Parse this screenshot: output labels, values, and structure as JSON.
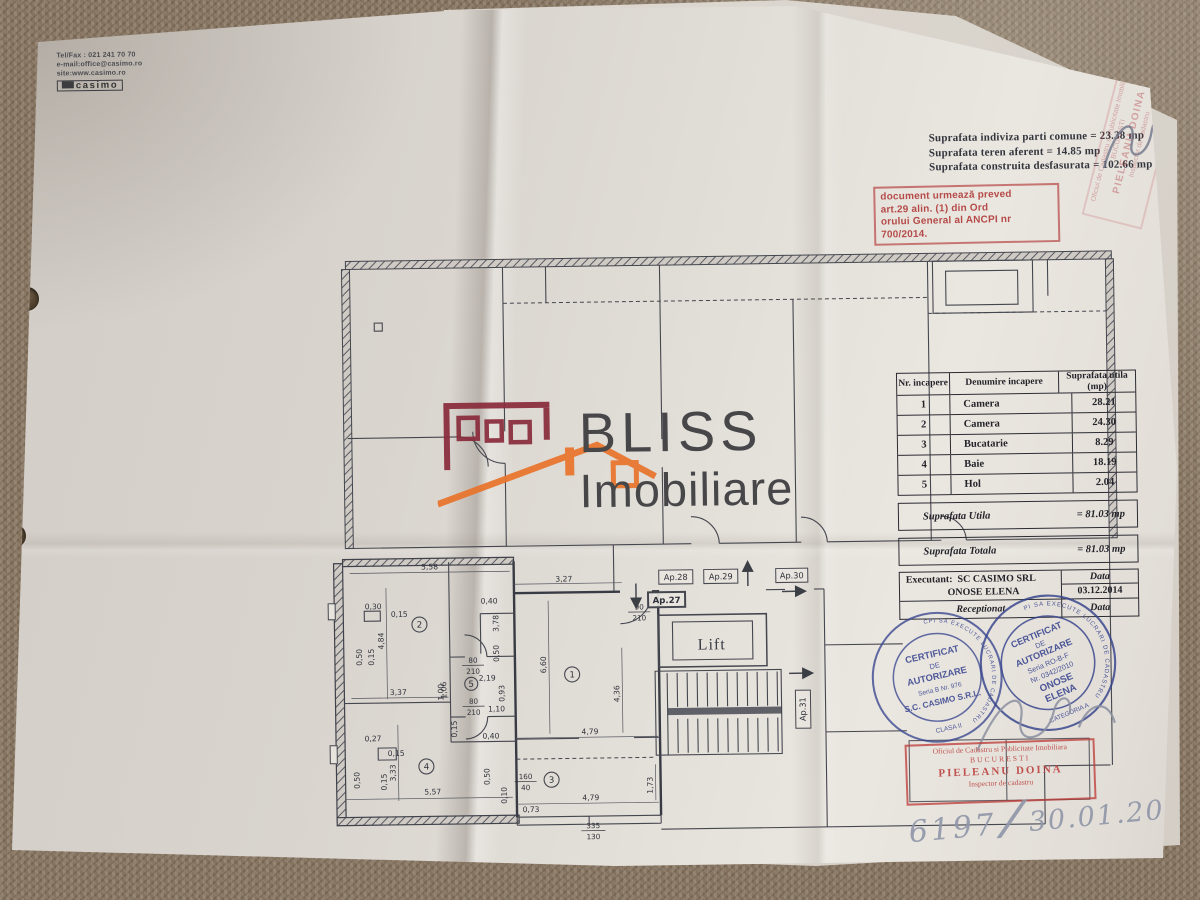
{
  "document": {
    "contact": {
      "line1": "Tel/Fax : 021 241 70 70",
      "line2": "e-mail:office@casimo.ro",
      "line3": "site:www.casimo.ro",
      "logo_text": "casimo"
    },
    "surface_summary": {
      "line1": "Suprafata indiviza parti comune = 23.38 mp",
      "line2": "Suprafata teren aferent = 14.85 mp",
      "line3": "Suprafata construita desfasurata = 102.66 mp"
    },
    "ordin_stamp": {
      "line1": "document urmează preved",
      "line2": "art.29 alin. (1) din Ord",
      "line3": "orului General al ANCPI nr",
      "line4": "700/2014."
    },
    "watermark": {
      "title": "BLISS",
      "subtitle": "Imobiliare"
    },
    "handwritten": {
      "number": "6197",
      "separator": "/",
      "date": "30.01.2015"
    }
  },
  "room_table": {
    "headers": {
      "col1": "Nr. incapere",
      "col2": "Denumire incapere",
      "col3": "Suprafata utila (mp)"
    },
    "rows": [
      {
        "nr": "1",
        "name": "Camera",
        "area": "28.21"
      },
      {
        "nr": "2",
        "name": "Camera",
        "area": "24.30"
      },
      {
        "nr": "3",
        "name": "Bucatarie",
        "area": "8.29"
      },
      {
        "nr": "4",
        "name": "Baie",
        "area": "18.19"
      },
      {
        "nr": "5",
        "name": "Hol",
        "area": "2.04"
      }
    ],
    "totals": {
      "utila_label": "Suprafata Utila",
      "utila_value": "= 81.03 mp",
      "totala_label": "Suprafata Totala",
      "totala_value": "= 81.03 mp"
    },
    "footer": {
      "executant_label": "Executant:",
      "executant_company": "SC CASIMO SRL",
      "executant_name": "ONOSE ELENA",
      "data_label": "Data",
      "data_value": "03.12.2014",
      "receptionat_label": "Receptionat",
      "receptionat_data_label": "Data"
    }
  },
  "plan": {
    "apartments": {
      "ap27": "Ap.27",
      "ap28": "Ap.28",
      "ap29": "Ap.29",
      "ap30": "Ap.30",
      "ap31": "Ap.31"
    },
    "lift_label": "Lift",
    "rooms": [
      "1",
      "2",
      "3",
      "4",
      "5"
    ],
    "door_labels": {
      "w80": "80",
      "h210": "210",
      "w90": "90",
      "w160": "160",
      "h40": "40",
      "w335": "335",
      "h130": "130"
    },
    "dims": [
      "5,58",
      "0,30",
      "0,15",
      "4,84",
      "0,50",
      "0,15",
      "3,37",
      "1,06",
      "0,40",
      "3,78",
      "0,50",
      "3,27",
      "6,60",
      "4,36",
      "4,79",
      "4,79",
      "1,73",
      "0,73",
      "2,19",
      "0,93",
      "1,00",
      "1,10",
      "0,15",
      "0,40",
      "0,27",
      "0,15",
      "3,33",
      "0,50",
      "0,15",
      "5,57",
      "0,50",
      "0,10"
    ]
  },
  "stamps": {
    "casimo_round": {
      "ring": "PERSOANA JURIDICA AUTORIZATA DE ANCPI SA EXECUTE LUCRARI DE CADASTRU",
      "line1": "CERTIFICAT",
      "line2": "DE",
      "line3": "AUTORIZARE",
      "line4": "Seria B Nr. 976",
      "line5": "S.C. CASIMO S.R.L.",
      "line6": "CLASA II"
    },
    "onose_round": {
      "ring": "PERSOANA FIZICA AUTORIZATA DE ANCPI SA EXECUTE LUCRARI DE CADASTRU",
      "line1": "CERTIFICAT",
      "line2": "DE",
      "line3": "AUTORIZARE",
      "line4": "Seria RO-B-F",
      "line5": "Nr. 0342/2010",
      "line6": "ONOSE",
      "line7": "ELENA",
      "line8": "CATEGORIA A"
    },
    "ocpi_box": {
      "line1": "Oficiul de Cadastru si Publicitate Imobiliara",
      "line2": "BUCURESTI",
      "line3": "PIELEANU DOINA",
      "line4": "Inspector de cadastru"
    }
  }
}
